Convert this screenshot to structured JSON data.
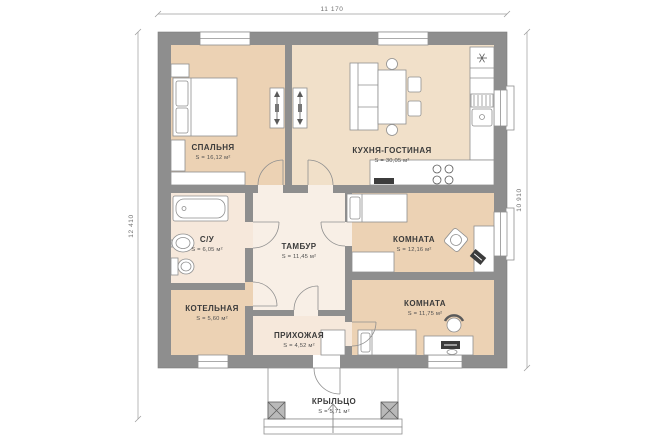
{
  "dimensions": {
    "top": "11 170",
    "left": "12 410",
    "right": "10 910"
  },
  "rooms": [
    {
      "id": "spalnya",
      "name": "СПАЛЬНЯ",
      "area": "S = 16,12 м²"
    },
    {
      "id": "kuhnya-gostinaya",
      "name": "КУХНЯ-ГОСТИНАЯ",
      "area": "S = 30,05 м²"
    },
    {
      "id": "su",
      "name": "С/У",
      "area": "S = 6,05 м²"
    },
    {
      "id": "tambur",
      "name": "ТАМБУР",
      "area": "S = 11,45 м²"
    },
    {
      "id": "komnata-1",
      "name": "КОМНАТА",
      "area": "S = 12,16 м²"
    },
    {
      "id": "kotelnaya",
      "name": "КОТЕЛЬНАЯ",
      "area": "S = 5,60 м²"
    },
    {
      "id": "prihozhaya",
      "name": "ПРИХОЖАЯ",
      "area": "S = 4,52 м²"
    },
    {
      "id": "komnata-2",
      "name": "КОМНАТА",
      "area": "S = 11,75 м²"
    },
    {
      "id": "krylco",
      "name": "КРЫЛЬЦО",
      "area": "S = 5,71 м²"
    }
  ],
  "colors": {
    "wall": "#8e8e8e",
    "room_tan": "#ecd2b4",
    "room_beige": "#f1e0c9",
    "room_peach": "#f6e8db",
    "room_light": "#f8efe6",
    "background": "#ffffff"
  }
}
